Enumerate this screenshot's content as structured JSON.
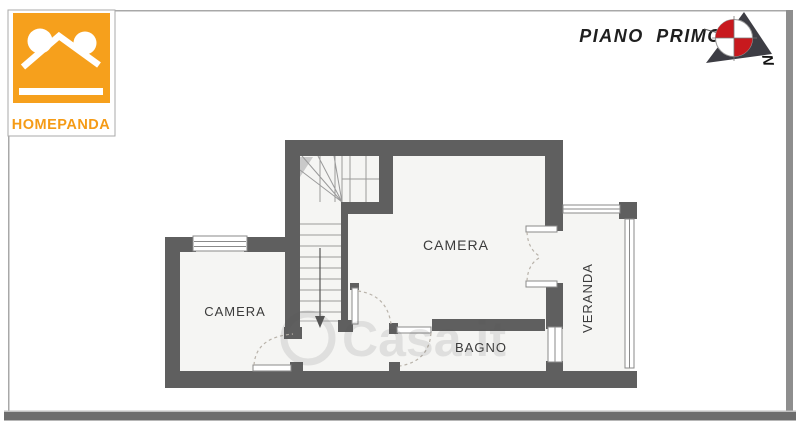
{
  "header": {
    "title": "PIANO PRIMO"
  },
  "logo": {
    "wordmark": "HOMEPANDA"
  },
  "compass": {
    "north_label": "N"
  },
  "floorplan": {
    "rooms": [
      {
        "id": "camera-main",
        "label": "CAMERA"
      },
      {
        "id": "camera-left",
        "label": "CAMERA"
      },
      {
        "id": "bagno",
        "label": "BAGNO"
      },
      {
        "id": "veranda",
        "label": "VERANDA"
      }
    ]
  },
  "watermark": {
    "text": "Casa.it"
  },
  "colors": {
    "brand_orange": "#F6A01C",
    "compass_red": "#C8191E",
    "wall_gray": "#5F5F5F",
    "floor_gray": "#F5F5F3"
  }
}
